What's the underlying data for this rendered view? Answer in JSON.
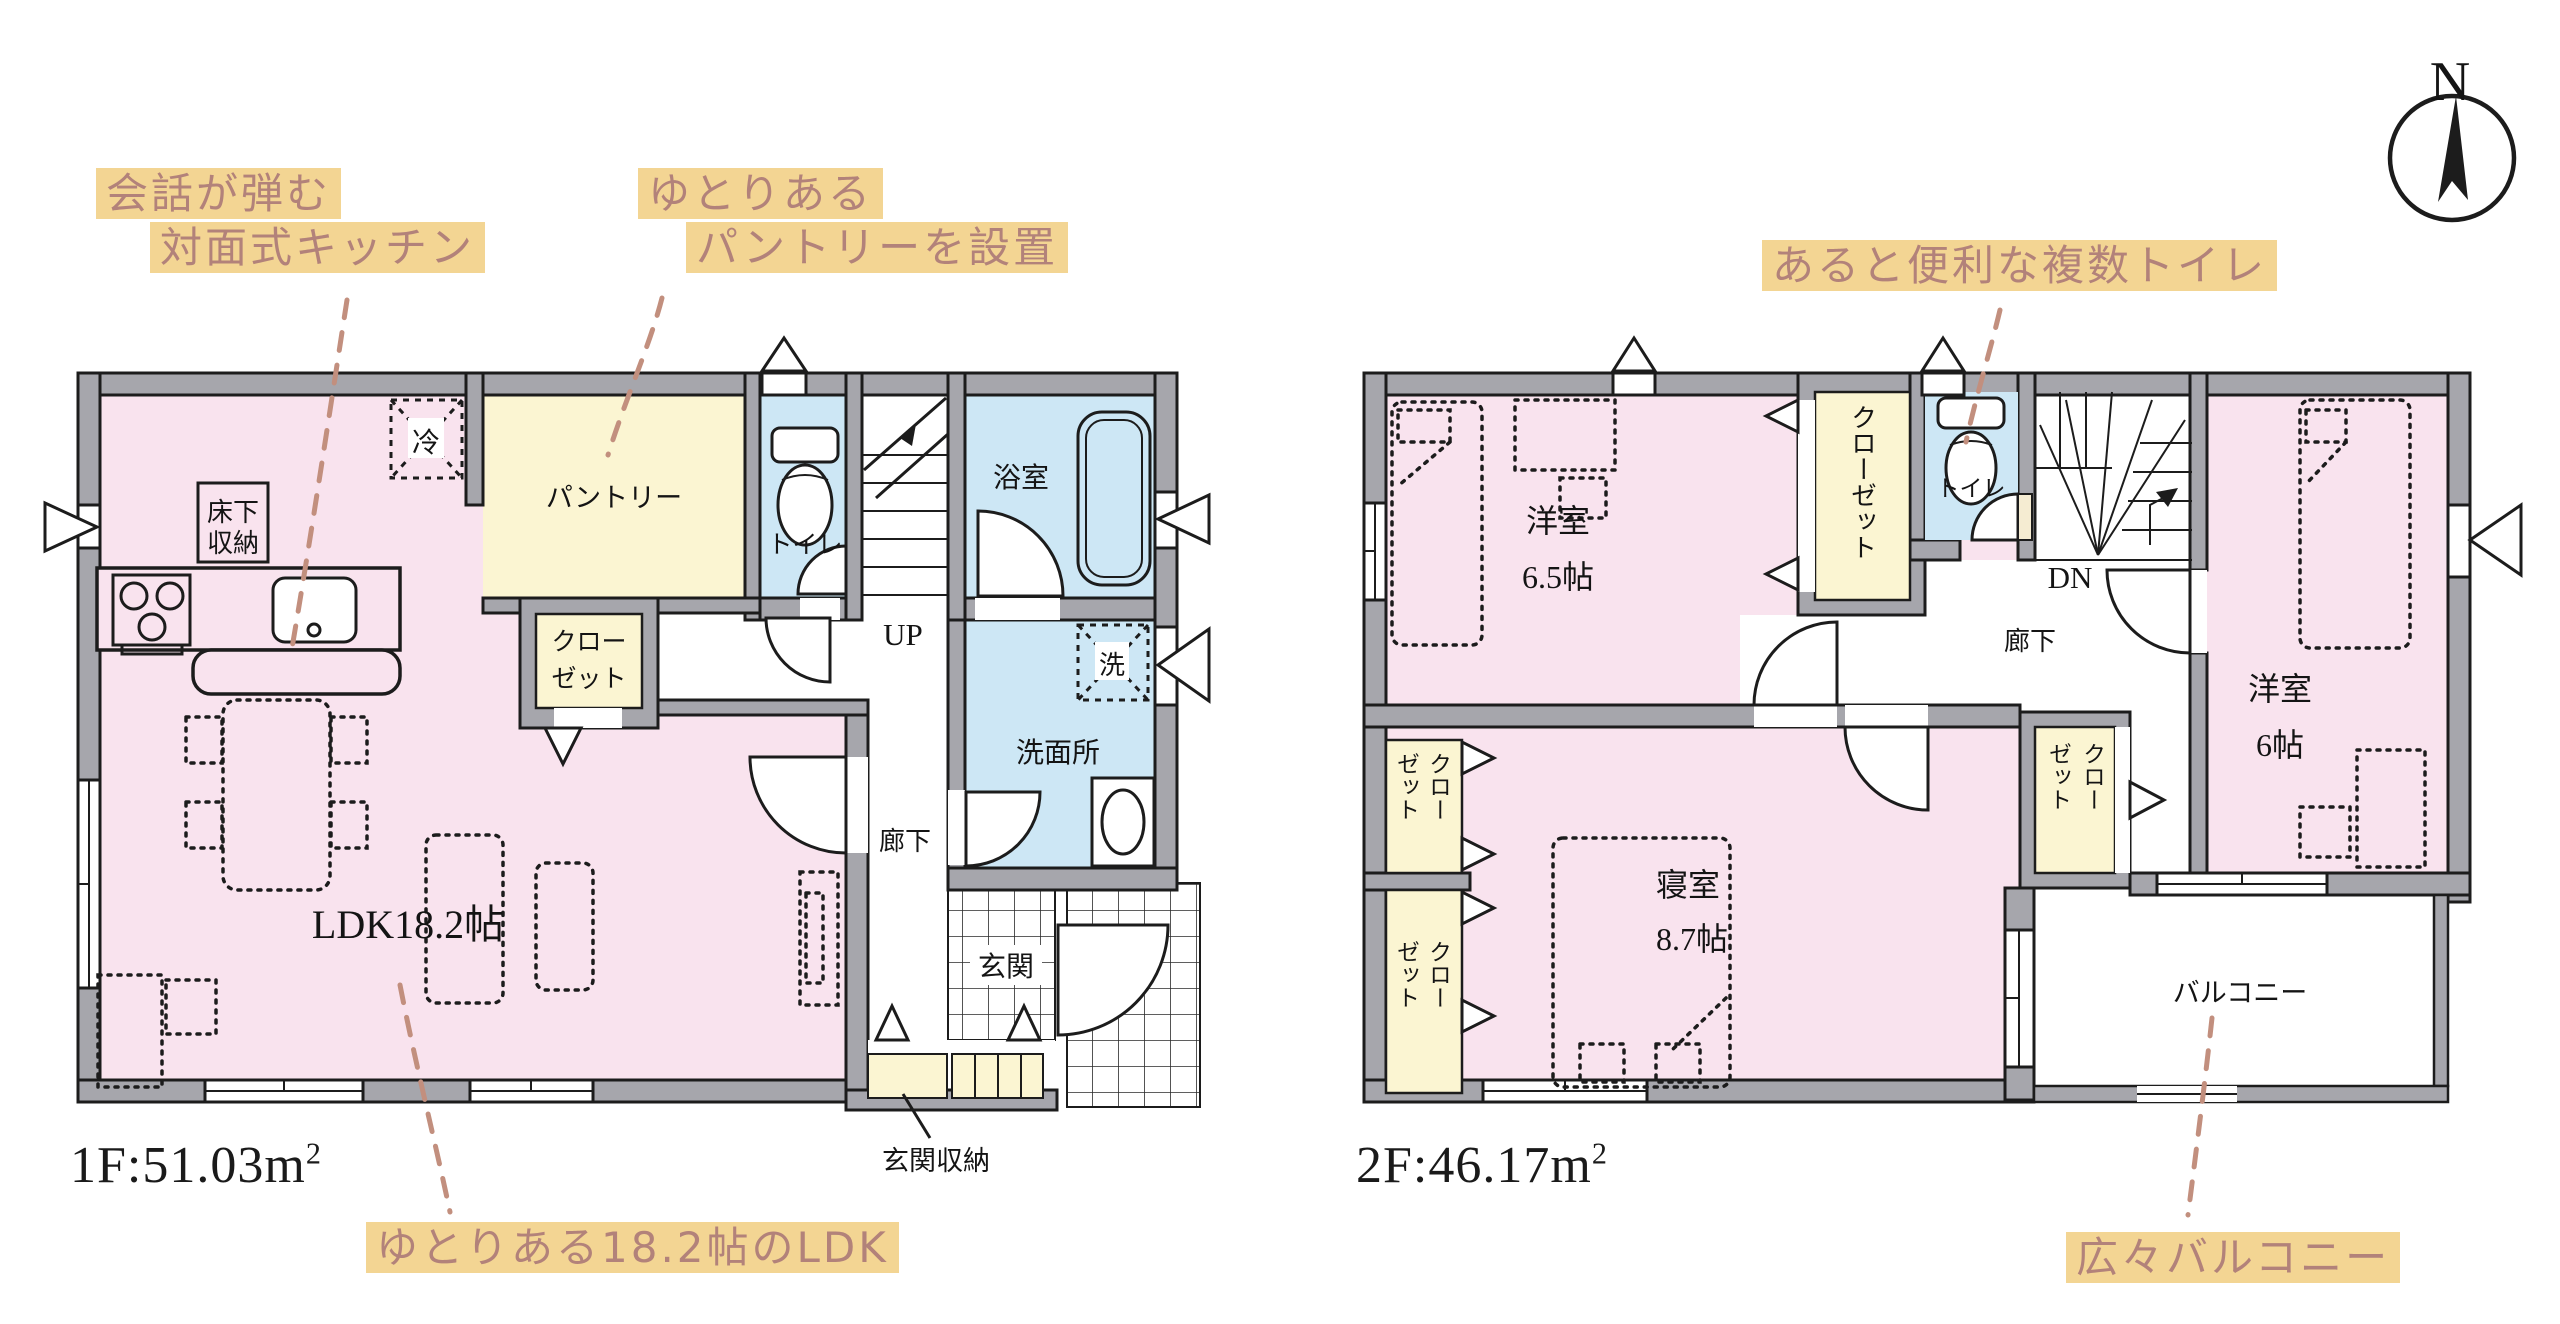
{
  "compass": {
    "label": "N"
  },
  "annotations": {
    "kitchen": {
      "line1": "会話が弾む",
      "line2": "対面式キッチン"
    },
    "pantry": {
      "line1": "ゆとりある",
      "line2": "パントリーを設置"
    },
    "toilets": {
      "line1": "あると便利な複数トイレ"
    },
    "ldk": {
      "line1": "ゆとりある18.2帖のLDK"
    },
    "balcony": {
      "line1": "広々バルコニー"
    }
  },
  "floor1": {
    "area_main": "1F:51.03m",
    "area_sup": "2",
    "rooms": {
      "ldk": "LDK18.2帖",
      "pantry": "パントリー",
      "closet_l1": "クロー",
      "closet_l2": "ゼット",
      "toilet": "トイレ",
      "bath": "浴室",
      "washroom": "洗面所",
      "washer": "洗",
      "fridge": "冷",
      "underfloor_l1": "床下",
      "underfloor_l2": "収納",
      "stairs": "UP",
      "hall": "廊下",
      "entrance": "玄関",
      "entrance_storage": "玄関収納"
    }
  },
  "floor2": {
    "area_main": "2F:46.17m",
    "area_sup": "2",
    "rooms": {
      "room65_name": "洋室",
      "room65_size": "6.5帖",
      "closet_top": "クローゼット",
      "toilet": "トイレ",
      "stairs": "DN",
      "hall": "廊下",
      "room6_name": "洋室",
      "room6_size": "6帖",
      "bedroom_name": "寝室",
      "bedroom_size": "8.7帖",
      "closet_col_kuro": "クロー",
      "closet_col_zetto": "ゼット",
      "balcony": "バルコニー"
    }
  }
}
